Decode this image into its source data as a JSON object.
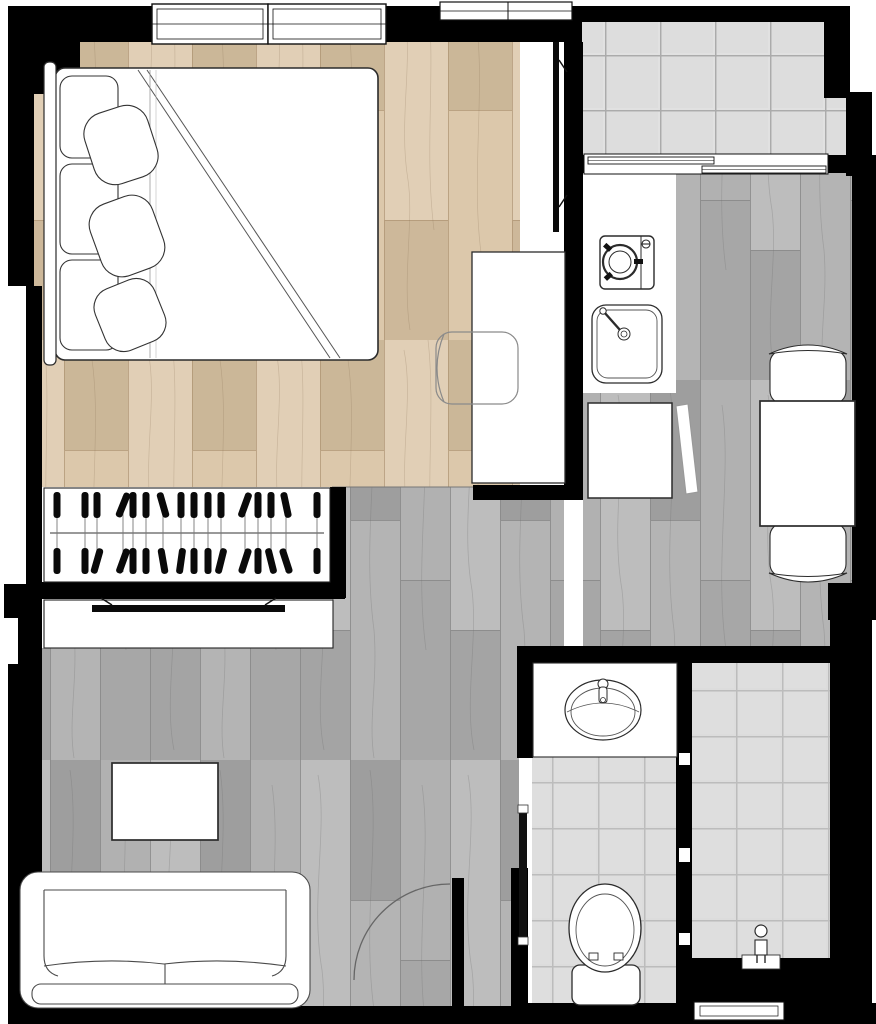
{
  "document": {
    "description": "Architectural floor plan of a one-bedroom apartment, top-down view, no text labels",
    "canvas": {
      "width_px": 876,
      "height_px": 1024
    }
  },
  "colors": {
    "background": "#ffffff",
    "wall": "#000000",
    "bedroom_floor": "#d8c2a2",
    "bedroom_floor_seam": "#a98f6d",
    "gray_floor": "#aeaeae",
    "gray_floor_seam": "#878787",
    "balcony_tile": "#e1e1e1",
    "balcony_tile_line": "#ababab",
    "bathroom_tile": "#dcdcdc",
    "bathroom_tile_line": "#bcbcbc",
    "furniture_fill": "#ffffff",
    "furniture_stroke": "#2b2b2b",
    "sketch_stroke": "#606060"
  },
  "rooms": [
    {
      "name": "bedroom",
      "floor": "light-wood-plank"
    },
    {
      "name": "walk-in-closet",
      "floor": "white"
    },
    {
      "name": "hallway",
      "floor": "gray-wood-plank"
    },
    {
      "name": "living-room",
      "floor": "gray-wood-plank"
    },
    {
      "name": "kitchen",
      "floor": "gray-wood-plank"
    },
    {
      "name": "dining-nook",
      "floor": "gray-wood-plank"
    },
    {
      "name": "balcony",
      "floor": "ceramic-tile"
    },
    {
      "name": "toilet-room",
      "floor": "ceramic-tile"
    },
    {
      "name": "shower-room",
      "floor": "ceramic-tile"
    }
  ],
  "symbols": [
    "double-bed-with-pillows",
    "headboard",
    "duvet-fold-lines",
    "wall-mounted-tv-bedroom",
    "desk",
    "desk-chair",
    "wardrobe-rail",
    "clothes-hangers",
    "tv-console",
    "wall-mounted-tv-living",
    "coffee-table",
    "sofa",
    "entry-door-swing",
    "washing-machine",
    "kitchen-sink",
    "refrigerator",
    "open-cabinet-door",
    "dining-table",
    "dining-chair-north",
    "dining-chair-south",
    "balcony-sliding-door",
    "window-double",
    "window-single",
    "vanity-counter",
    "basin-sink",
    "toilet",
    "shower-mixer",
    "bathroom-pocket-door",
    "glass-partition-joints",
    "bathroom-window"
  ],
  "closet": {
    "rail_y": 533,
    "hangers": [
      {
        "x": 57,
        "t": 0,
        "b": 0
      },
      {
        "x": 85,
        "t": 0,
        "b": 0
      },
      {
        "x": 97,
        "t": 0,
        "b": 16
      },
      {
        "x": 123,
        "t": 22,
        "b": 20
      },
      {
        "x": 133,
        "t": 0,
        "b": 0
      },
      {
        "x": 146,
        "t": 0,
        "b": 0
      },
      {
        "x": 163,
        "t": -16,
        "b": -10
      },
      {
        "x": 181,
        "t": 0,
        "b": 8
      },
      {
        "x": 194,
        "t": 0,
        "b": 0
      },
      {
        "x": 208,
        "t": 0,
        "b": 0
      },
      {
        "x": 221,
        "t": 0,
        "b": 14
      },
      {
        "x": 245,
        "t": 20,
        "b": 18
      },
      {
        "x": 258,
        "t": 0,
        "b": 0
      },
      {
        "x": 271,
        "t": 0,
        "b": -14
      },
      {
        "x": 286,
        "t": -12,
        "b": -18
      },
      {
        "x": 317,
        "t": 0,
        "b": 0
      }
    ]
  }
}
